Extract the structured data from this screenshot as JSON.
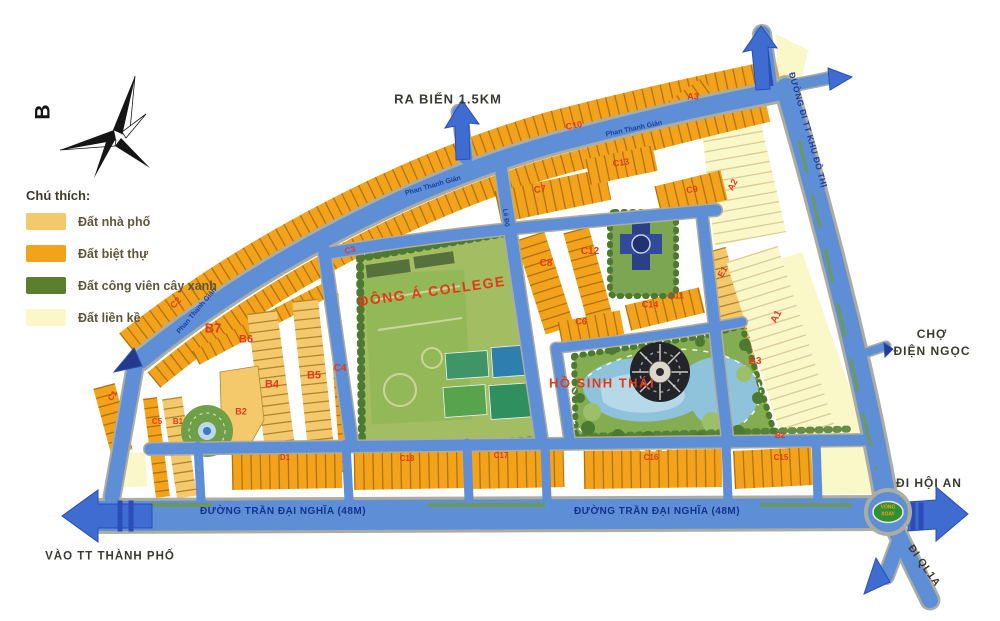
{
  "map": {
    "colors": {
      "road": "#5e8fd6",
      "road_casing": "#acaca0",
      "arrow": "#3f6cd0",
      "arrow_dark": "#2b4db8",
      "villa": "#f2a31b",
      "townhouse": "#f3c96b",
      "adjacent": "#faf7c8",
      "park": "#84ad52",
      "park_dark": "#4c7a31",
      "field": "#a3bd62",
      "water": "#8fc3dc",
      "water_light": "#cfe8f2",
      "label_red": "#e23a18",
      "street_navy": "#1c3e9e",
      "text_dark": "#3a3a30",
      "road_label_navy": "#14318f",
      "median_green": "#6a9a5a",
      "lot_line": "#7a4a00"
    },
    "legend": {
      "title": "Chú thích:",
      "items": [
        {
          "label": "Đất nhà phố",
          "color": "#f3c96b"
        },
        {
          "label": "Đất biệt thự",
          "color": "#f2a31b"
        },
        {
          "label": "Đất công viên cây xanh",
          "color": "#5c7e2f"
        },
        {
          "label": "Đất liền kề",
          "color": "#faf7c8"
        }
      ]
    },
    "compass": {
      "label": "B"
    },
    "labels": [
      {
        "name": "road-label-ra-bien",
        "text": "RA BIỂN 1.5KM",
        "x": 448,
        "y": 99,
        "rot": 0,
        "size": 13,
        "color": "#3a3a30",
        "ls": 1
      },
      {
        "name": "road-label-tt-khu-do-thi",
        "text": "ĐƯỜNG ĐI TT KHU ĐÔ THỊ",
        "x": 808,
        "y": 130,
        "rot": 74,
        "size": 8.5,
        "color": "#1c3e9e",
        "ls": 0.5
      },
      {
        "name": "road-label-cho",
        "text": "CHỢ",
        "x": 932,
        "y": 334,
        "rot": 0,
        "size": 12,
        "color": "#3a3a30",
        "ls": 1
      },
      {
        "name": "road-label-dien-ngoc",
        "text": "ĐIỆN NGỌC",
        "x": 932,
        "y": 351,
        "rot": 0,
        "size": 12,
        "color": "#3a3a30",
        "ls": 1
      },
      {
        "name": "road-label-di-hoi-an",
        "text": "ĐI HỘI AN",
        "x": 929,
        "y": 483,
        "rot": 0,
        "size": 12,
        "color": "#3a3a30",
        "ls": 1
      },
      {
        "name": "road-label-di-ql1a",
        "text": "ĐI QL1A",
        "x": 924,
        "y": 566,
        "rot": 55,
        "size": 10.5,
        "color": "#3a3a30",
        "ls": 1
      },
      {
        "name": "road-label-vao-tt",
        "text": "VÀO TT THÀNH PHỐ",
        "x": 110,
        "y": 557,
        "rot": 0,
        "size": 11.5,
        "color": "#3a3a30",
        "ls": 1
      },
      {
        "name": "road-label-tran-dai-nghia-1",
        "text": "ĐƯỜNG TRẦN ĐẠI NGHĨA (48M)",
        "x": 283,
        "y": 512,
        "rot": 0,
        "size": 10,
        "color": "#14318f",
        "ls": 0.5
      },
      {
        "name": "road-label-tran-dai-nghia-2",
        "text": "ĐƯỜNG TRẦN ĐẠI NGHĨA (48M)",
        "x": 657,
        "y": 512,
        "rot": 0,
        "size": 10,
        "color": "#14318f",
        "ls": 0.5
      },
      {
        "name": "street-label-phan-thanh-gian-1",
        "text": "Phan Thanh Giản",
        "x": 197,
        "y": 311,
        "rot": -50,
        "size": 7,
        "color": "#1c3e9e",
        "weight": "600"
      },
      {
        "name": "street-label-phan-thanh-gian-2",
        "text": "Phan Thanh Giản",
        "x": 433,
        "y": 186,
        "rot": -16,
        "size": 7,
        "color": "#1c3e9e",
        "weight": "600"
      },
      {
        "name": "street-label-phan-thanh-gian-3",
        "text": "Phan Thanh Giản",
        "x": 634,
        "y": 129,
        "rot": -12,
        "size": 7,
        "color": "#1c3e9e",
        "weight": "600"
      },
      {
        "name": "street-label-le-do",
        "text": "Lê Độ",
        "x": 505,
        "y": 218,
        "rot": 82,
        "size": 6.5,
        "color": "#1c3e9e",
        "weight": "600"
      },
      {
        "name": "landmark-label-college",
        "text": "ĐÔNG Á COLLEGE",
        "x": 432,
        "y": 291,
        "rot": -8,
        "size": 14,
        "color": "#e23a18",
        "ls": 1.5
      },
      {
        "name": "landmark-label-ho-sinh-thai",
        "text": "HỒ SINH THÁI",
        "x": 602,
        "y": 383,
        "rot": 0,
        "size": 13,
        "color": "#e23a18",
        "ls": 1.5
      },
      {
        "name": "roundabout-label-line1",
        "text": "VÒNG",
        "x": 888,
        "y": 508,
        "rot": 0,
        "size": 5,
        "color": "#f6a21a"
      },
      {
        "name": "roundabout-label-line2",
        "text": "XOAY",
        "x": 888,
        "y": 515,
        "rot": 0,
        "size": 5,
        "color": "#f6a21a"
      },
      {
        "name": "block-label-a3",
        "text": "A3",
        "x": 693,
        "y": 97,
        "rot": 0,
        "size": 9,
        "color": "#e23a18"
      },
      {
        "name": "block-label-c10",
        "text": "C10",
        "x": 574,
        "y": 126,
        "rot": -10,
        "size": 9,
        "color": "#e23a18"
      },
      {
        "name": "block-label-c13",
        "text": "C13",
        "x": 621,
        "y": 163,
        "rot": -8,
        "size": 9,
        "color": "#e23a18"
      },
      {
        "name": "block-label-c9",
        "text": "C9",
        "x": 692,
        "y": 190,
        "rot": -8,
        "size": 9,
        "color": "#e23a18"
      },
      {
        "name": "block-label-a2",
        "text": "A2",
        "x": 733,
        "y": 185,
        "rot": -62,
        "size": 9,
        "color": "#e23a18"
      },
      {
        "name": "block-label-c7",
        "text": "C7",
        "x": 540,
        "y": 190,
        "rot": -8,
        "size": 9.5,
        "color": "#e23a18"
      },
      {
        "name": "block-label-c3",
        "text": "C3",
        "x": 350,
        "y": 250,
        "rot": -14,
        "size": 8.5,
        "color": "#e23a18"
      },
      {
        "name": "block-label-c2",
        "text": "C2",
        "x": 176,
        "y": 303,
        "rot": -45,
        "size": 9,
        "color": "#e23a18"
      },
      {
        "name": "block-label-b7",
        "text": "B7",
        "x": 213,
        "y": 328,
        "rot": 0,
        "size": 13,
        "color": "#e23a18"
      },
      {
        "name": "block-label-b6",
        "text": "B6",
        "x": 246,
        "y": 340,
        "rot": 0,
        "size": 11,
        "color": "#e23a18"
      },
      {
        "name": "block-label-c8",
        "text": "C8",
        "x": 546,
        "y": 264,
        "rot": 0,
        "size": 10,
        "color": "#e23a18"
      },
      {
        "name": "block-label-c12",
        "text": "C12",
        "x": 590,
        "y": 252,
        "rot": 0,
        "size": 10,
        "color": "#e23a18"
      },
      {
        "name": "block-label-c14",
        "text": "C14",
        "x": 650,
        "y": 305,
        "rot": 0,
        "size": 9,
        "color": "#e23a18"
      },
      {
        "name": "block-label-c11",
        "text": "C11",
        "x": 676,
        "y": 296,
        "rot": 0,
        "size": 9,
        "color": "#e23a18"
      },
      {
        "name": "block-label-c6",
        "text": "C6",
        "x": 581,
        "y": 322,
        "rot": 0,
        "size": 9,
        "color": "#e23a18"
      },
      {
        "name": "block-label-e1",
        "text": "E1",
        "x": 723,
        "y": 272,
        "rot": -62,
        "size": 9,
        "color": "#e23a18"
      },
      {
        "name": "block-label-a1",
        "text": "A1",
        "x": 777,
        "y": 317,
        "rot": -62,
        "size": 10,
        "color": "#e23a18"
      },
      {
        "name": "block-label-b3",
        "text": "B3",
        "x": 755,
        "y": 362,
        "rot": 0,
        "size": 10,
        "color": "#e23a18"
      },
      {
        "name": "block-label-c4",
        "text": "C4",
        "x": 340,
        "y": 369,
        "rot": 0,
        "size": 10,
        "color": "#e23a18"
      },
      {
        "name": "block-label-b5",
        "text": "B5",
        "x": 314,
        "y": 376,
        "rot": 0,
        "size": 11,
        "color": "#e23a18"
      },
      {
        "name": "block-label-b4",
        "text": "B4",
        "x": 272,
        "y": 385,
        "rot": 0,
        "size": 11,
        "color": "#e23a18"
      },
      {
        "name": "block-label-b2",
        "text": "B2",
        "x": 241,
        "y": 412,
        "rot": 0,
        "size": 9,
        "color": "#e23a18"
      },
      {
        "name": "block-label-c5",
        "text": "C5",
        "x": 157,
        "y": 422,
        "rot": 0,
        "size": 8,
        "color": "#e23a18"
      },
      {
        "name": "block-label-b1",
        "text": "B1",
        "x": 178,
        "y": 422,
        "rot": 0,
        "size": 8,
        "color": "#e23a18"
      },
      {
        "name": "block-label-c1",
        "text": "C1",
        "x": 113,
        "y": 396,
        "rot": -55,
        "size": 8,
        "color": "#e23a18"
      },
      {
        "name": "block-label-b2-strip",
        "text": "B2",
        "x": 780,
        "y": 436,
        "rot": 0,
        "size": 8,
        "color": "#e23a18"
      },
      {
        "name": "block-label-d1",
        "text": "D1",
        "x": 285,
        "y": 458,
        "rot": 0,
        "size": 8,
        "color": "#e23a18"
      },
      {
        "name": "block-label-c18",
        "text": "C18",
        "x": 407,
        "y": 459,
        "rot": 0,
        "size": 8,
        "color": "#e23a18"
      },
      {
        "name": "block-label-c17",
        "text": "C17",
        "x": 501,
        "y": 456,
        "rot": 0,
        "size": 8,
        "color": "#e23a18"
      },
      {
        "name": "block-label-c16",
        "text": "C16",
        "x": 651,
        "y": 458,
        "rot": 0,
        "size": 8,
        "color": "#e23a18"
      },
      {
        "name": "block-label-c15",
        "text": "C15",
        "x": 781,
        "y": 458,
        "rot": 0,
        "size": 8,
        "color": "#e23a18"
      }
    ]
  }
}
